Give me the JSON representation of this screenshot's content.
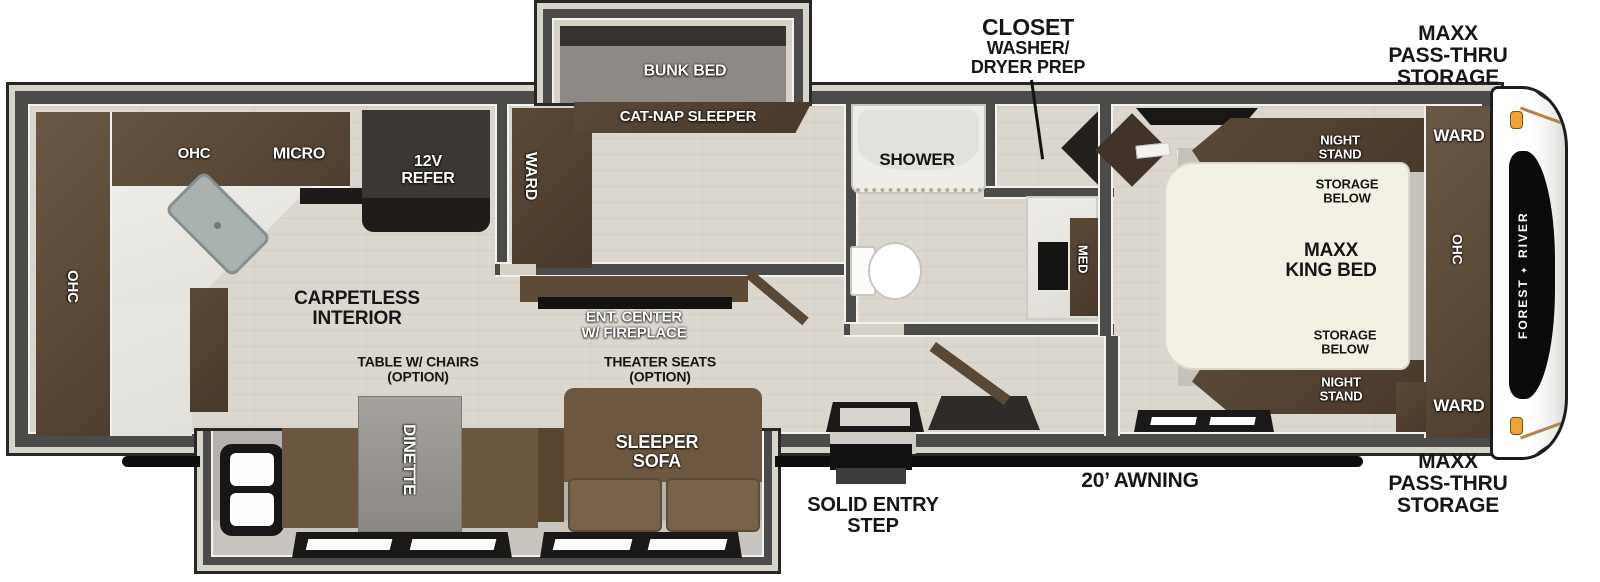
{
  "brand": {
    "line1": "FOREST",
    "emblem": "✦",
    "line2": "RIVER"
  },
  "colors": {
    "wall": "#4b4b49",
    "cabinet_brown": "#5d4b3a",
    "bed_ivory": "#f3f0e4",
    "awning_bar": "#0d0d0d",
    "cap_marker_light": "#f2a335",
    "floor": "#dbd7ce"
  },
  "exterior": {
    "closet": {
      "title": "CLOSET",
      "line2": "WASHER/",
      "line3": "DRYER PREP"
    },
    "storage_front_top": {
      "line1": "MAXX",
      "line2": "PASS-THRU",
      "line3": "STORAGE"
    },
    "storage_front_bottom": {
      "line1": "MAXX",
      "line2": "PASS-THRU",
      "line3": "STORAGE"
    },
    "awning": "20’ AWNING",
    "entry_step": {
      "line1": "SOLID ENTRY",
      "line2": "STEP"
    }
  },
  "kitchen": {
    "ohc_top": "OHC",
    "micro": "MICRO",
    "ohc_rear": "OHC",
    "refrigerator": {
      "line1": "12V",
      "line2": "REFER"
    }
  },
  "bunk_room": {
    "bunk_bed": "BUNK BED",
    "cat_nap_sleeper": "CAT-NAP SLEEPER",
    "wardrobe": "WARD"
  },
  "bathroom": {
    "shower": "SHOWER",
    "medicine_cabinet": "MED"
  },
  "living_area": {
    "carpetless": {
      "line1": "CARPETLESS",
      "line2": "INTERIOR"
    },
    "ent_center": {
      "line1": "ENT. CENTER",
      "line2": "W/ FIREPLACE"
    },
    "table_option": {
      "line1": "TABLE W/ CHAIRS",
      "line2": "(OPTION)"
    },
    "theater_option": {
      "line1": "THEATER SEATS",
      "line2": "(OPTION)"
    },
    "dinette": "DINETTE",
    "sleeper_sofa": {
      "line1": "SLEEPER",
      "line2": "SOFA"
    }
  },
  "bedroom": {
    "night_stand_top": {
      "line1": "NIGHT",
      "line2": "STAND"
    },
    "storage_below_top": {
      "line1": "STORAGE",
      "line2": "BELOW"
    },
    "king_bed": {
      "line1": "MAXX",
      "line2": "KING BED"
    },
    "storage_below_bottom": {
      "line1": "STORAGE",
      "line2": "BELOW"
    },
    "night_stand_bottom": {
      "line1": "NIGHT",
      "line2": "STAND"
    },
    "ward_top": "WARD",
    "ohc": "OHC",
    "ward_bottom": "WARD"
  }
}
